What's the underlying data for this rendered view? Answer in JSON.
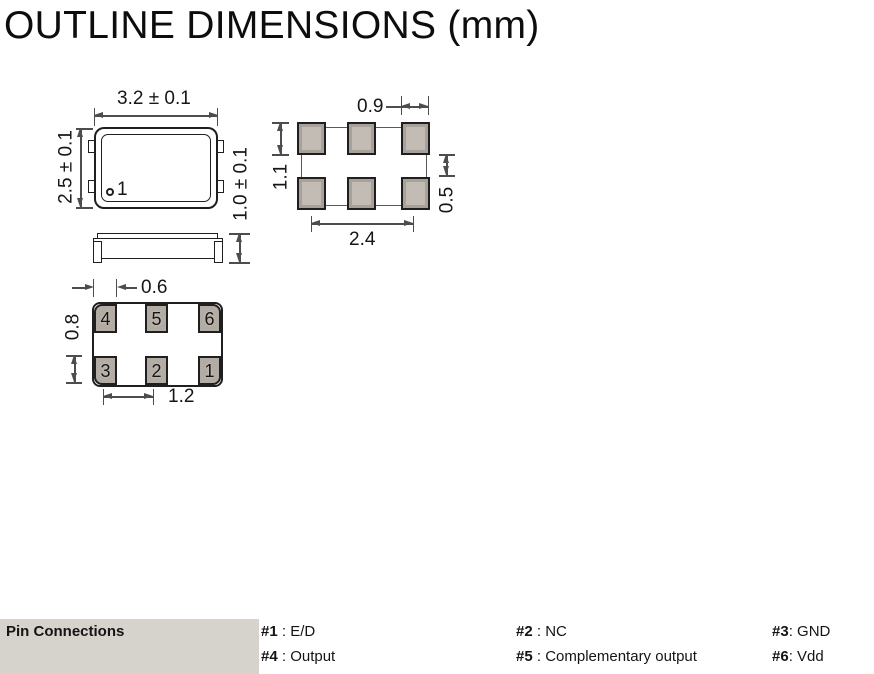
{
  "title": "OUTLINE DIMENSIONS (mm)",
  "top_view": {
    "body_width": "3.2 ± 0.1",
    "body_height": "2.5 ± 0.1",
    "pin1_marker": "1"
  },
  "land_pattern": {
    "pad_width": "0.9",
    "pad_height": "1.1",
    "row_gap": "0.5",
    "horizontal_span": "2.4"
  },
  "side_view": {
    "thickness": "1.0 ± 0.1"
  },
  "bottom_view": {
    "pad_width": "0.6",
    "pad_height": "0.8",
    "pad_pitch": "1.2",
    "pin_numbers_top_row": [
      "4",
      "5",
      "6"
    ],
    "pin_numbers_bottom_row": [
      "3",
      "2",
      "1"
    ]
  },
  "pin_connections": {
    "label": "Pin Connections",
    "entries": [
      {
        "pin": "#1",
        "desc": " : E/D"
      },
      {
        "pin": "#2",
        "desc": " : NC"
      },
      {
        "pin": "#3",
        "desc": ": GND"
      },
      {
        "pin": "#4",
        "desc": " : Output"
      },
      {
        "pin": "#5",
        "desc": " : Complementary output"
      },
      {
        "pin": "#6",
        "desc": ": Vdd"
      }
    ]
  },
  "colors": {
    "pad_fill": "#a8a19a",
    "pad_fill_light": "#c2bcb4",
    "bottom_pad_fill": "#b2aca5",
    "strip_background": "#d6d2cc",
    "part_line": "#1f1f1f",
    "dimension_line": "#4d4d4d"
  }
}
